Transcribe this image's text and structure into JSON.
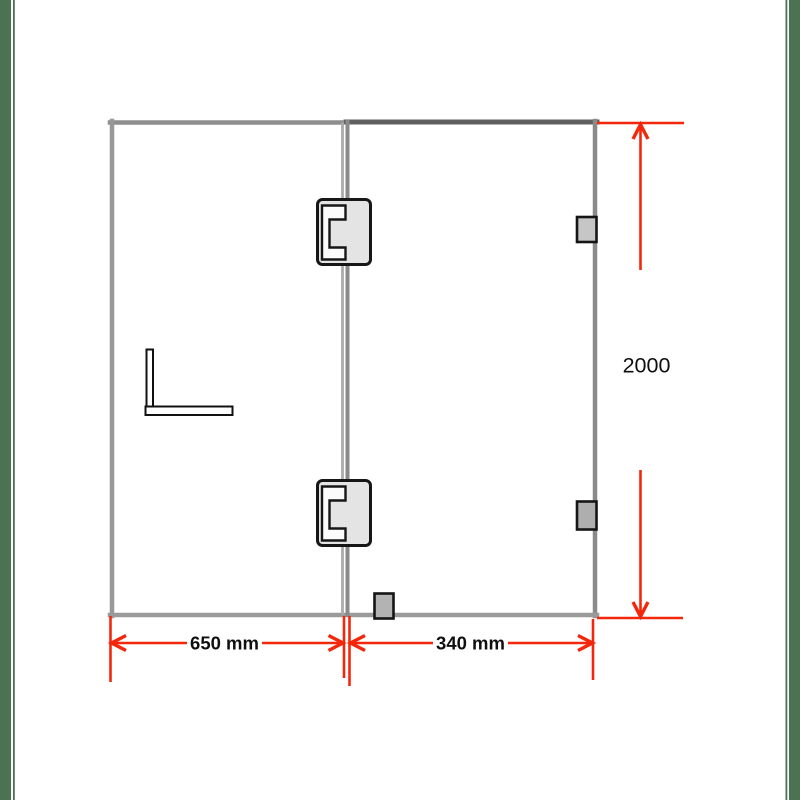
{
  "labels": {
    "left_panel_width": "650 mm",
    "right_panel_width": "340 mm",
    "total_height": "2000"
  },
  "colors": {
    "dimension_red": "#f3270b",
    "glass_edge_gray": "#919191",
    "hardware_outline_black": "#161616",
    "hinge_fill_gray": "#e4e4e4",
    "clip_fill_gray": "#b3b3b3",
    "border_stripe_green": "#4a7253"
  },
  "hardware": {
    "hinge_top": "glass-door-hinge",
    "hinge_bottom": "glass-door-hinge",
    "clip_top_right": "glass-wall-clip",
    "clip_mid_right": "glass-wall-clip",
    "clip_bottom_center": "glass-floor-clip",
    "bracket": "l-shaped-support-bracket"
  }
}
